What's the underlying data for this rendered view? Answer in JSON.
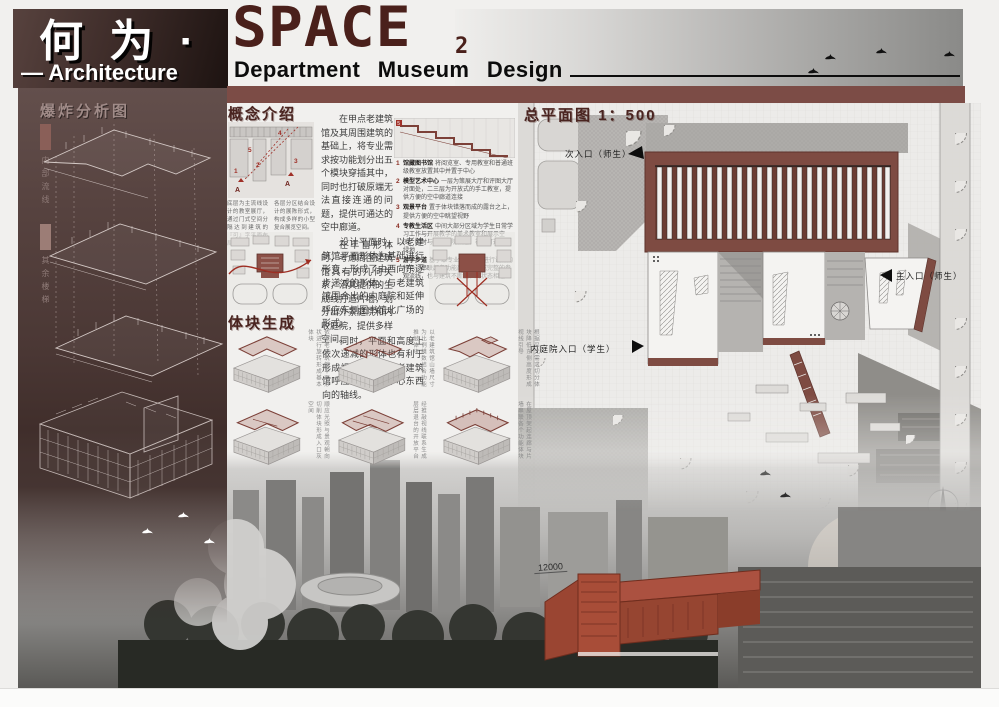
{
  "header": {
    "title_cn": "何 为 ·",
    "title_en": "SPACE",
    "title_index": "2",
    "subtitle_left": "— Architecture",
    "subtitle_right": "Department  Museum  Design"
  },
  "sidebar": {
    "heading": "爆炸分析图",
    "legend": [
      {
        "label": "内部流线",
        "color": "#8a5f58"
      },
      {
        "label": "其余楼梯",
        "color": "#9c7d76"
      }
    ]
  },
  "concept": {
    "heading": "概念介绍",
    "paragraphs": [
      "在甲点老建筑馆及其周围建筑的基础上，将专业需求按功能划分出五个模块穿插其中，同时也打破原端无法直接连通的问题，提供可通达的空中廊道。",
      "在丰富形体时，考虑周围建筑馆具有的几何关系，沿其提供的生成线打造片墙，划分出外景庭院和内收庭院，提供多样空间。",
      "设计平面时，以老建筑馆平面形体为基础进行形变，形成了由西向东逐步递减的形体，与老建筑馆围合出的内庭院和延伸呼应东侧图书馆北广场的形式。",
      "同时，平面和高度上依次递减的形体也有利于形成视线引导，与老建筑馆呼应南面校区中心东西向的轴线。"
    ],
    "section_captions": [
      "底层为主流线设计的教室展厅，通过门式空间分隔达到建筑的『可』字平面布局。",
      "各层分区结合设计的展陈形式，构成多样的小型复合展览空间。"
    ],
    "section_markers": [
      "1",
      "2",
      "3",
      "4",
      "5"
    ],
    "marker_a": "A",
    "step_marker": "5",
    "program_list": [
      {
        "num": "1",
        "title": "馆藏图书馆",
        "desc": "将阅览室、专用教室和普通班级教室放置其中并置于中心"
      },
      {
        "num": "2",
        "title": "模型艺术中心",
        "desc": "一层为策展大厅和评图大厅对面处，二三层为开放式的手工教室，提供方便的空中廊道连接"
      },
      {
        "num": "3",
        "title": "观景平台",
        "desc": "置于体块错落而成的露台之上，提供方便的空中眺望视野"
      },
      {
        "num": "4",
        "title": "专教生活区",
        "desc": "中间大部分区域为学生日常学习工作与开展教学的美术教室和展示空间，同时与三个庭院相连，视线可达对面绿地"
      },
      {
        "num": "5",
        "title": "游学步道",
        "desc": "基于本专业实地调研进行设计的特色，串联起各功能部分，构成完整的参观流线，也与建筑不断生长的状态相连"
      }
    ]
  },
  "massing": {
    "heading": "体块生成",
    "steps": [
      {
        "caption": "依照老建筑馆平面形状进行旋转形成基本体块"
      },
      {
        "caption": "以老建筑馆山墙尺寸为比例模数结合功能推敲体块"
      },
      {
        "caption": "根据采光需求切分体块降低东侧高度形成视线引导"
      },
      {
        "caption": "顺应光照与景观朝向切削体块形成入口灰空间"
      },
      {
        "caption": "经推敲视线联系生成层层退台的开放平台"
      },
      {
        "caption": "在屋顶架起连廊与片墙串联各个功能体块"
      }
    ]
  },
  "siteplan": {
    "heading": "总平面图 1：500",
    "labels": {
      "secondary_entrance": "次入口（师生）",
      "main_entrance": "主入口（师生）",
      "courtyard_entrance": "内庭院入口（学生）"
    }
  },
  "photo": {
    "dimension_label": "12000"
  },
  "colors": {
    "band_maroon": "#7c4c46",
    "title_maroon": "#4a201b",
    "panel_maroon": "#4a3734",
    "accent_red": "#9e2d22",
    "roof_maroon": "#7e4b42"
  }
}
